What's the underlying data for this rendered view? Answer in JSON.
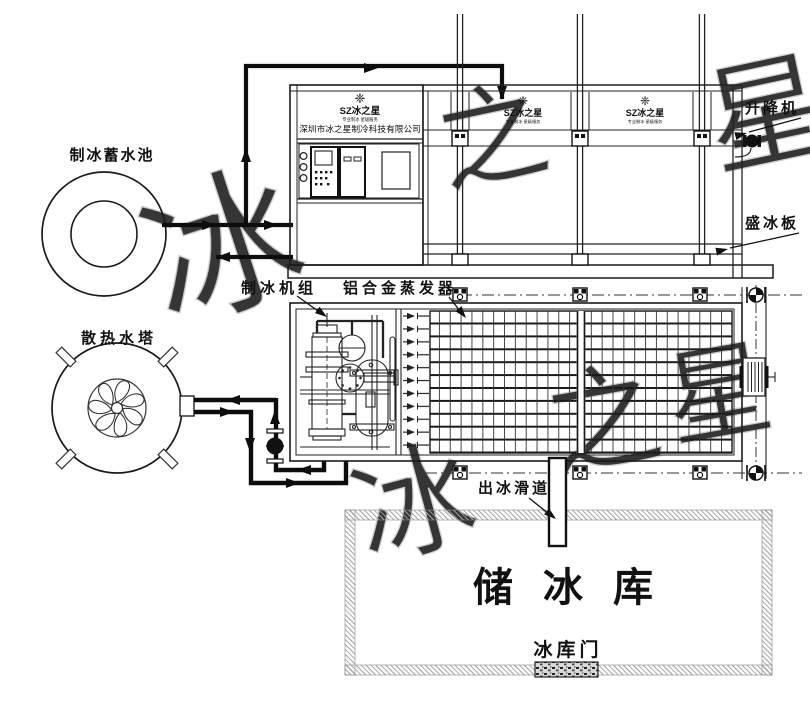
{
  "diagram": {
    "labels": {
      "pool": "制冰蓄水池",
      "tower": "散热水塔",
      "ice_unit": "制冰机组",
      "evaporator": "铝合金蒸发器",
      "lift": "升降机",
      "ice_plate": "盛冰板",
      "slide": "出冰滑道",
      "storage": "储冰库",
      "door": "冰库门"
    },
    "brand": {
      "logo_mark": "❈",
      "logo": "SZ冰之星",
      "tagline": "专业制冰 星级服务",
      "company": "深圳市冰之星制冷科技有限公司",
      "watermark": [
        "冰",
        "之",
        "星"
      ]
    },
    "colors": {
      "line": "#1a1a1a",
      "pipe": "#0d0d0d",
      "watermark": "#c4c4c4",
      "wall": "#999999"
    }
  }
}
